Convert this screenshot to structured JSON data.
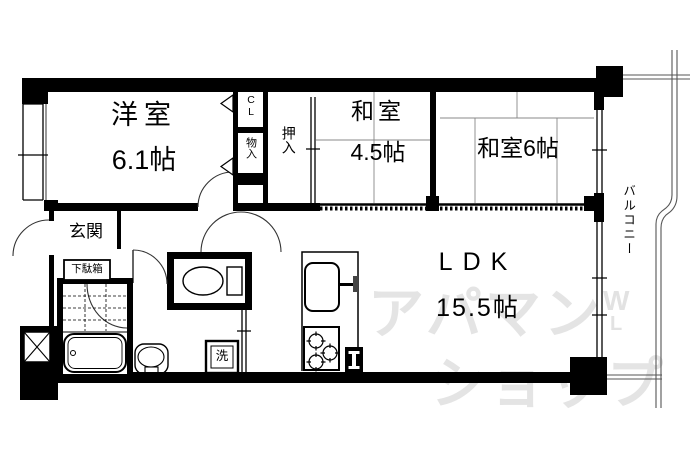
{
  "floorplan": {
    "rooms": {
      "yoshitsu": {
        "label": "洋室",
        "size": "6.1帖"
      },
      "washitsu45": {
        "label": "和室",
        "size": "4.5帖"
      },
      "washitsu6": {
        "label": "和室6帖"
      },
      "ldk": {
        "label": "LDK",
        "size": "15.5帖"
      },
      "genkan": {
        "label": "玄関"
      },
      "getabako": {
        "label": "下駄箱"
      },
      "oshiire": {
        "label": "押入"
      },
      "monoire": {
        "label": "物入"
      },
      "closet": {
        "label": "CL"
      },
      "balcony": {
        "label": "バルコニー"
      },
      "laundry": {
        "label": "洗"
      }
    },
    "fixtures": [
      "toilet-icon",
      "bathtub-icon",
      "washbasin-icon",
      "washing-machine-icon",
      "kitchen-sink-icon",
      "stove-icon",
      "pipe-space-icon",
      "shaft-x-icon"
    ],
    "watermark": {
      "line1": "アパマン",
      "line2": "ショップ",
      "logo_w": "W",
      "logo_l": "L"
    },
    "colors": {
      "wall": "#000000",
      "background": "#ffffff",
      "watermark_gray": "#e4e4e4",
      "thin_line": "#555555"
    }
  }
}
